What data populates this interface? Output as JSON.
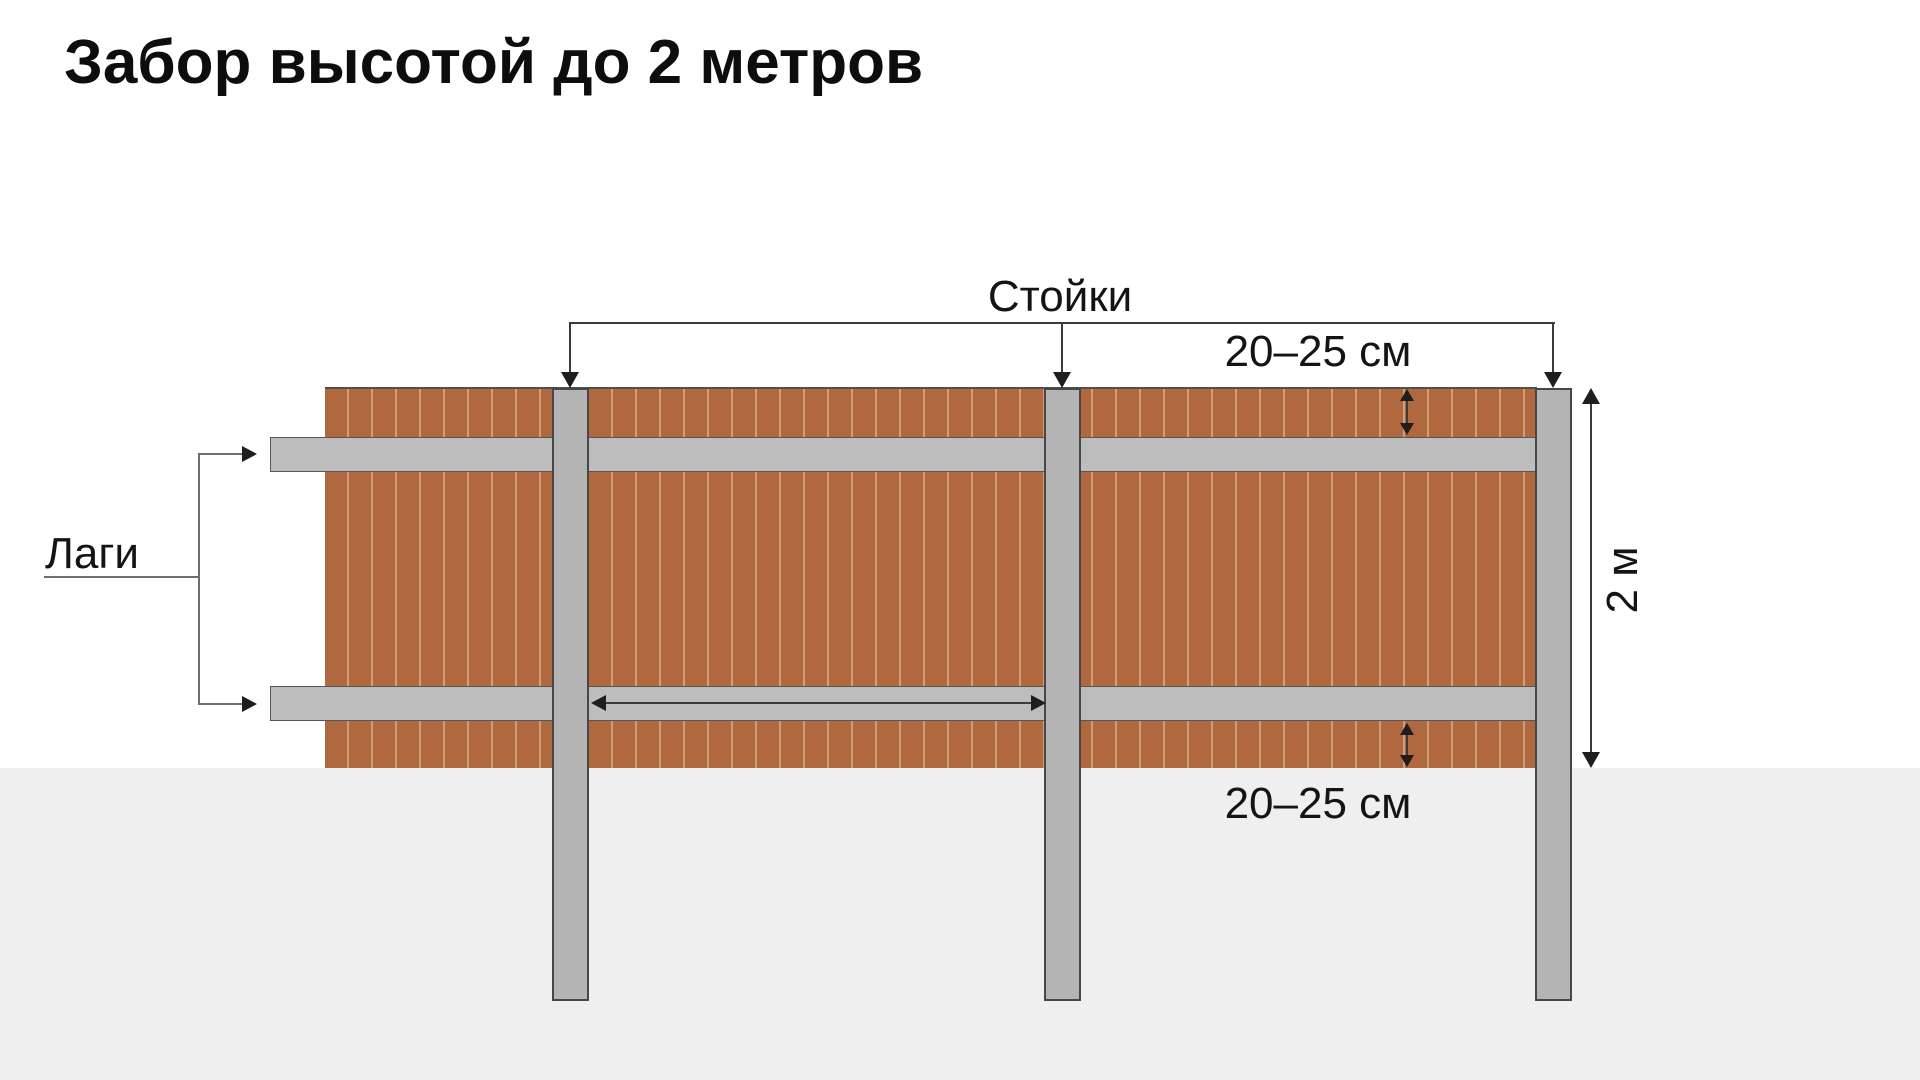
{
  "title": "Забор высотой до 2 метров",
  "labels": {
    "posts": "Стойки",
    "rails": "Лаги",
    "post_spacing": "1,5 – 2 м",
    "rail_offset_top": "20–25 см",
    "rail_offset_bottom": "20–25 см",
    "fence_height": "2 м"
  },
  "colors": {
    "background": "#ffffff",
    "ground": "#efefef",
    "plank": "#b0693f",
    "plank_seam": "#d19c76",
    "post": "#b4b4b4",
    "rail": "#bdbdbd",
    "line": "#3a3a3a",
    "text": "#141414"
  }
}
